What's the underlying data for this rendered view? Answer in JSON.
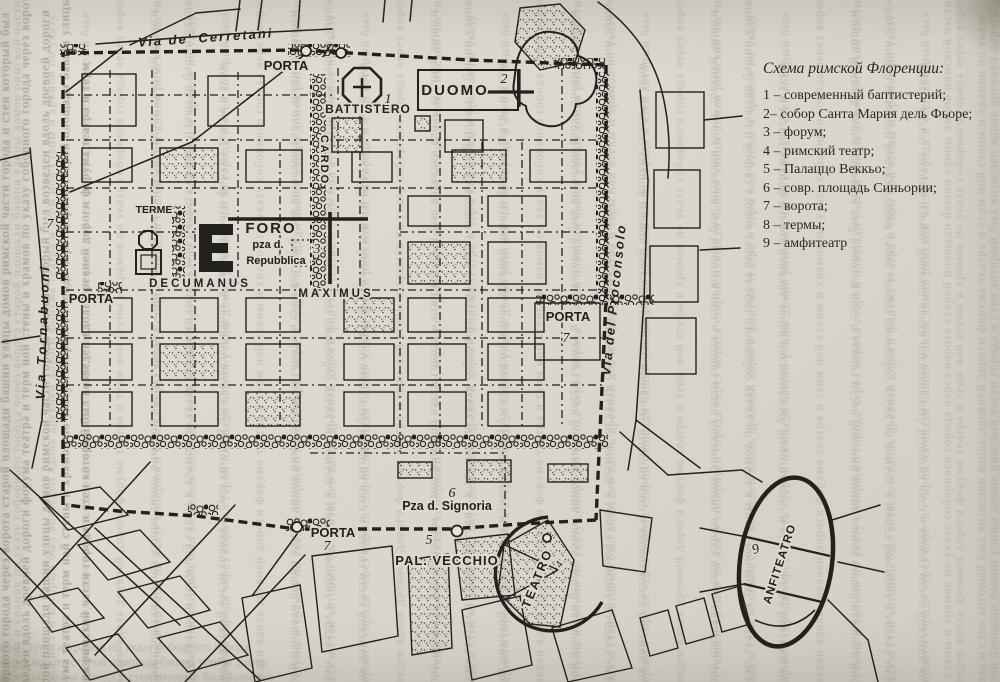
{
  "page": {
    "background": "#dcd8cf",
    "ink": "#23211d"
  },
  "legend": {
    "title": "Схема римской Флоренции:",
    "items": [
      {
        "label": "1 – современный баптистерий;"
      },
      {
        "label": "2– собор Санта Мария дель Фьоре;"
      },
      {
        "label": "3 – форум;"
      },
      {
        "label": "4 – римский театр;"
      },
      {
        "label": "5 – Палаццо Веккьо;"
      },
      {
        "label": "6 – совр. площадь Синьории;"
      },
      {
        "label": "7 – ворота;"
      },
      {
        "label": "8 – термы;"
      },
      {
        "label": "9 – амфитеатр"
      }
    ]
  },
  "map": {
    "streets": {
      "cerretani": "Via de' Cerretani",
      "tornabuoni": "Via Tornabuoni",
      "proconsolo": "Via del Proconsolo",
      "cardo": "CARDO",
      "decumanus": "DECUMANUS",
      "maximus": "MAXIMUS"
    },
    "places": {
      "porta_top": "PORTA",
      "porta_left": "PORTA",
      "porta_right": "PORTA",
      "porta_bottom": "PORTA",
      "battistero": "BATTISTERO",
      "duomo": "DUOMO",
      "terme": "TERME",
      "foro": "FORO",
      "foro_line2": "pza d.",
      "foro_line3": "Repubblica",
      "signoria": "Pza d. Signoria",
      "pal_vecchio": "PAL. VECCHIO",
      "teatro": "TEATRO",
      "anfiteatro": "ANFITEATRO"
    },
    "numbers": {
      "battistero": "1",
      "duomo": "2",
      "foro": "3",
      "teatro": "4",
      "pal_vecchio": "5",
      "signoria": "6",
      "porta_left": "7",
      "porta_right": "7",
      "porta_bottom": "7",
      "anfiteatro": "9"
    }
  },
  "bleed_text": "ной стены и храмов по указу соборного города через ворота старой площади башни улицы домов римской части города и стен который был возведен вдоль древней дороги форума театра и терм "
}
